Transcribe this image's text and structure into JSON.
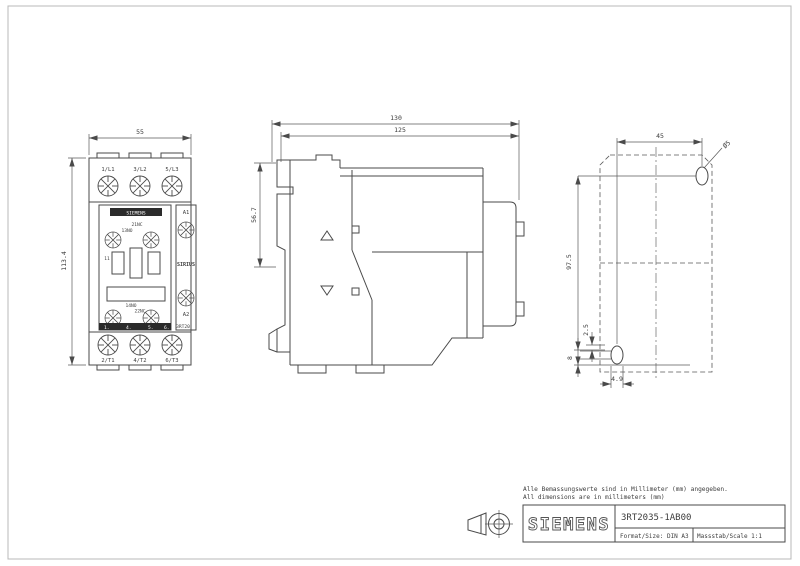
{
  "front_view": {
    "width_dim": "55",
    "height_dim": "113.4",
    "terminals_top": [
      "1/L1",
      "3/L2",
      "5/L3"
    ],
    "terminals_bottom": [
      "2/T1",
      "4/T2",
      "6/T3"
    ],
    "coil_a1": "A1",
    "coil_a2": "A2",
    "brand_strip": "SIEMENS",
    "series": "SIRIUS",
    "type_label": "3RT20",
    "aux_top_1": "21NC",
    "aux_top_2": "13NO",
    "aux_bottom_1": "14NO",
    "aux_bottom_2": "22NC",
    "pole_mark": "11",
    "bottom_marks": [
      "1.",
      "4.",
      "5.",
      "6."
    ]
  },
  "side_view": {
    "depth_total": "130",
    "depth_body": "125",
    "rail_height": "56.7"
  },
  "rear_view": {
    "hole_pitch_h": "45",
    "hole_pitch_v": "97.5",
    "offset_small": "2.5",
    "offset_bottom": "8",
    "slot_width": "4.9",
    "hole_dia": "Ø5"
  },
  "notes": {
    "line_de": "Alle Bemassungswerte sind in Millimeter (mm) angegeben.",
    "line_en": "All dimensions are in millimeters (mm)"
  },
  "title_block": {
    "brand": "SIEMENS",
    "product_code": "3RT2035-1AB00",
    "format": "Format/Size: DIN A3",
    "scale": "Massstab/Scale 1:1"
  },
  "colors": {
    "line": "#4a4a4a",
    "frame": "#b8b8b8",
    "dark_fill": "#2b2b2b"
  }
}
